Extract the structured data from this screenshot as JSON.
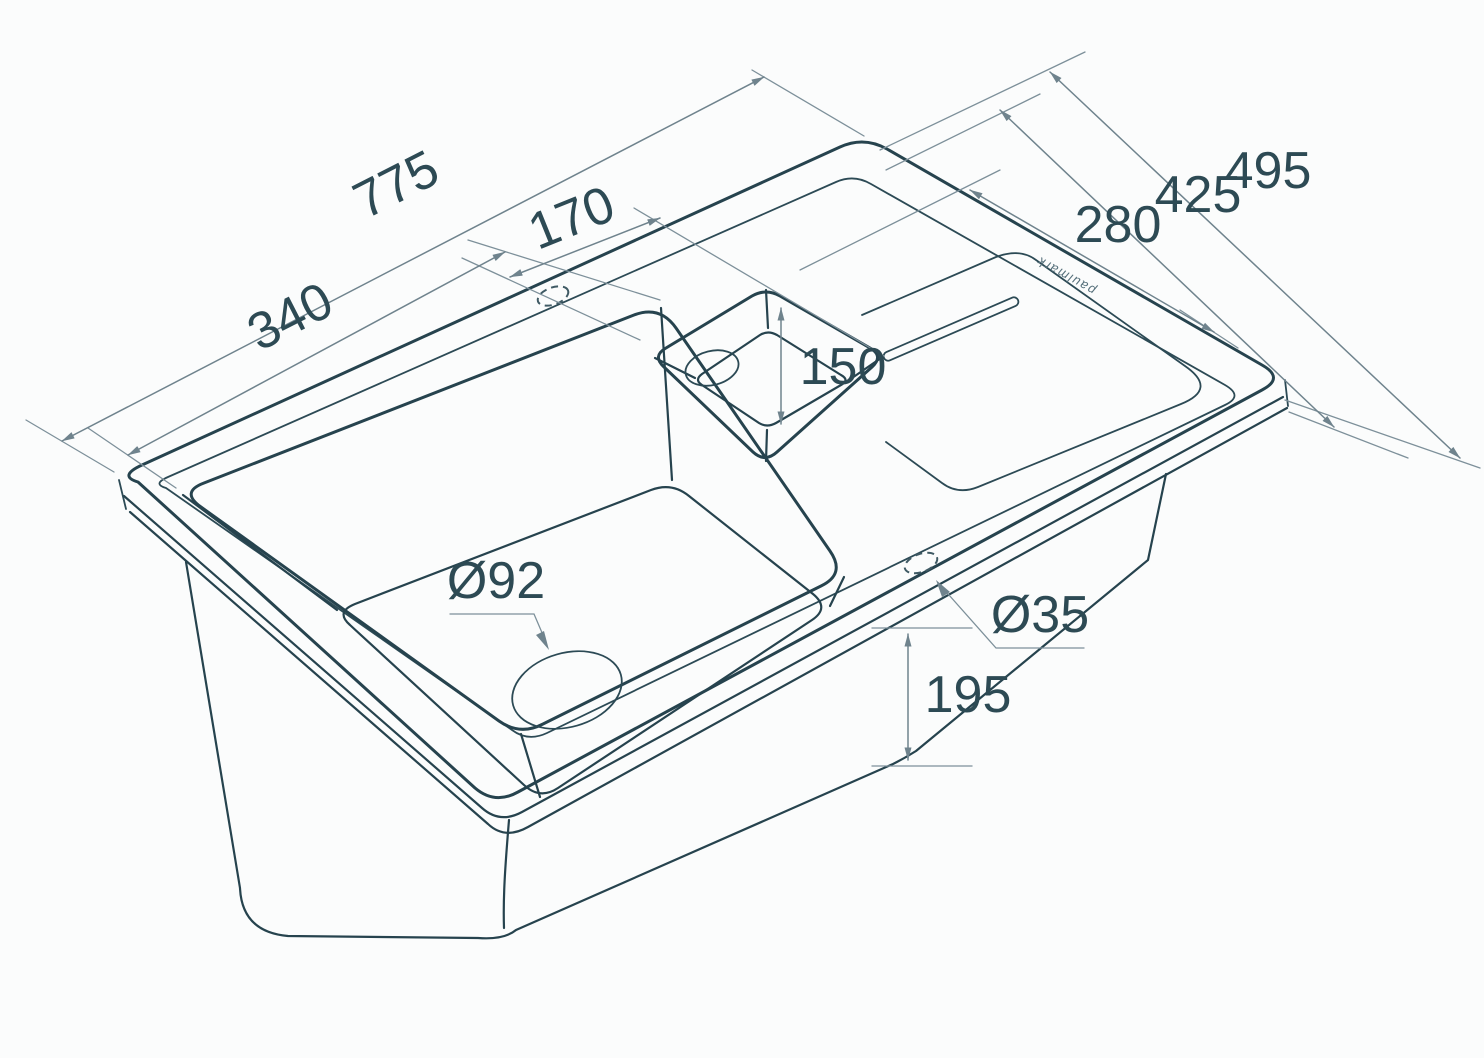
{
  "diagram": {
    "type": "technical-drawing",
    "subject": "kitchen sink with two bowls and drainboard, isometric projection",
    "brand": "paulmark",
    "line_color": "#26434e",
    "dimension_color": "#6f838d",
    "background": "#fbfcfc",
    "dimensions": {
      "overall_length": "775",
      "main_bowl_length": "340",
      "small_bowl_width": "170",
      "overall_width": "495",
      "inner_width": "425",
      "drainboard_width": "280",
      "small_bowl_inner": "150",
      "bowl_depth": "195",
      "main_drain_diameter": "Ø92",
      "faucet_hole_diameter": "Ø35"
    }
  }
}
